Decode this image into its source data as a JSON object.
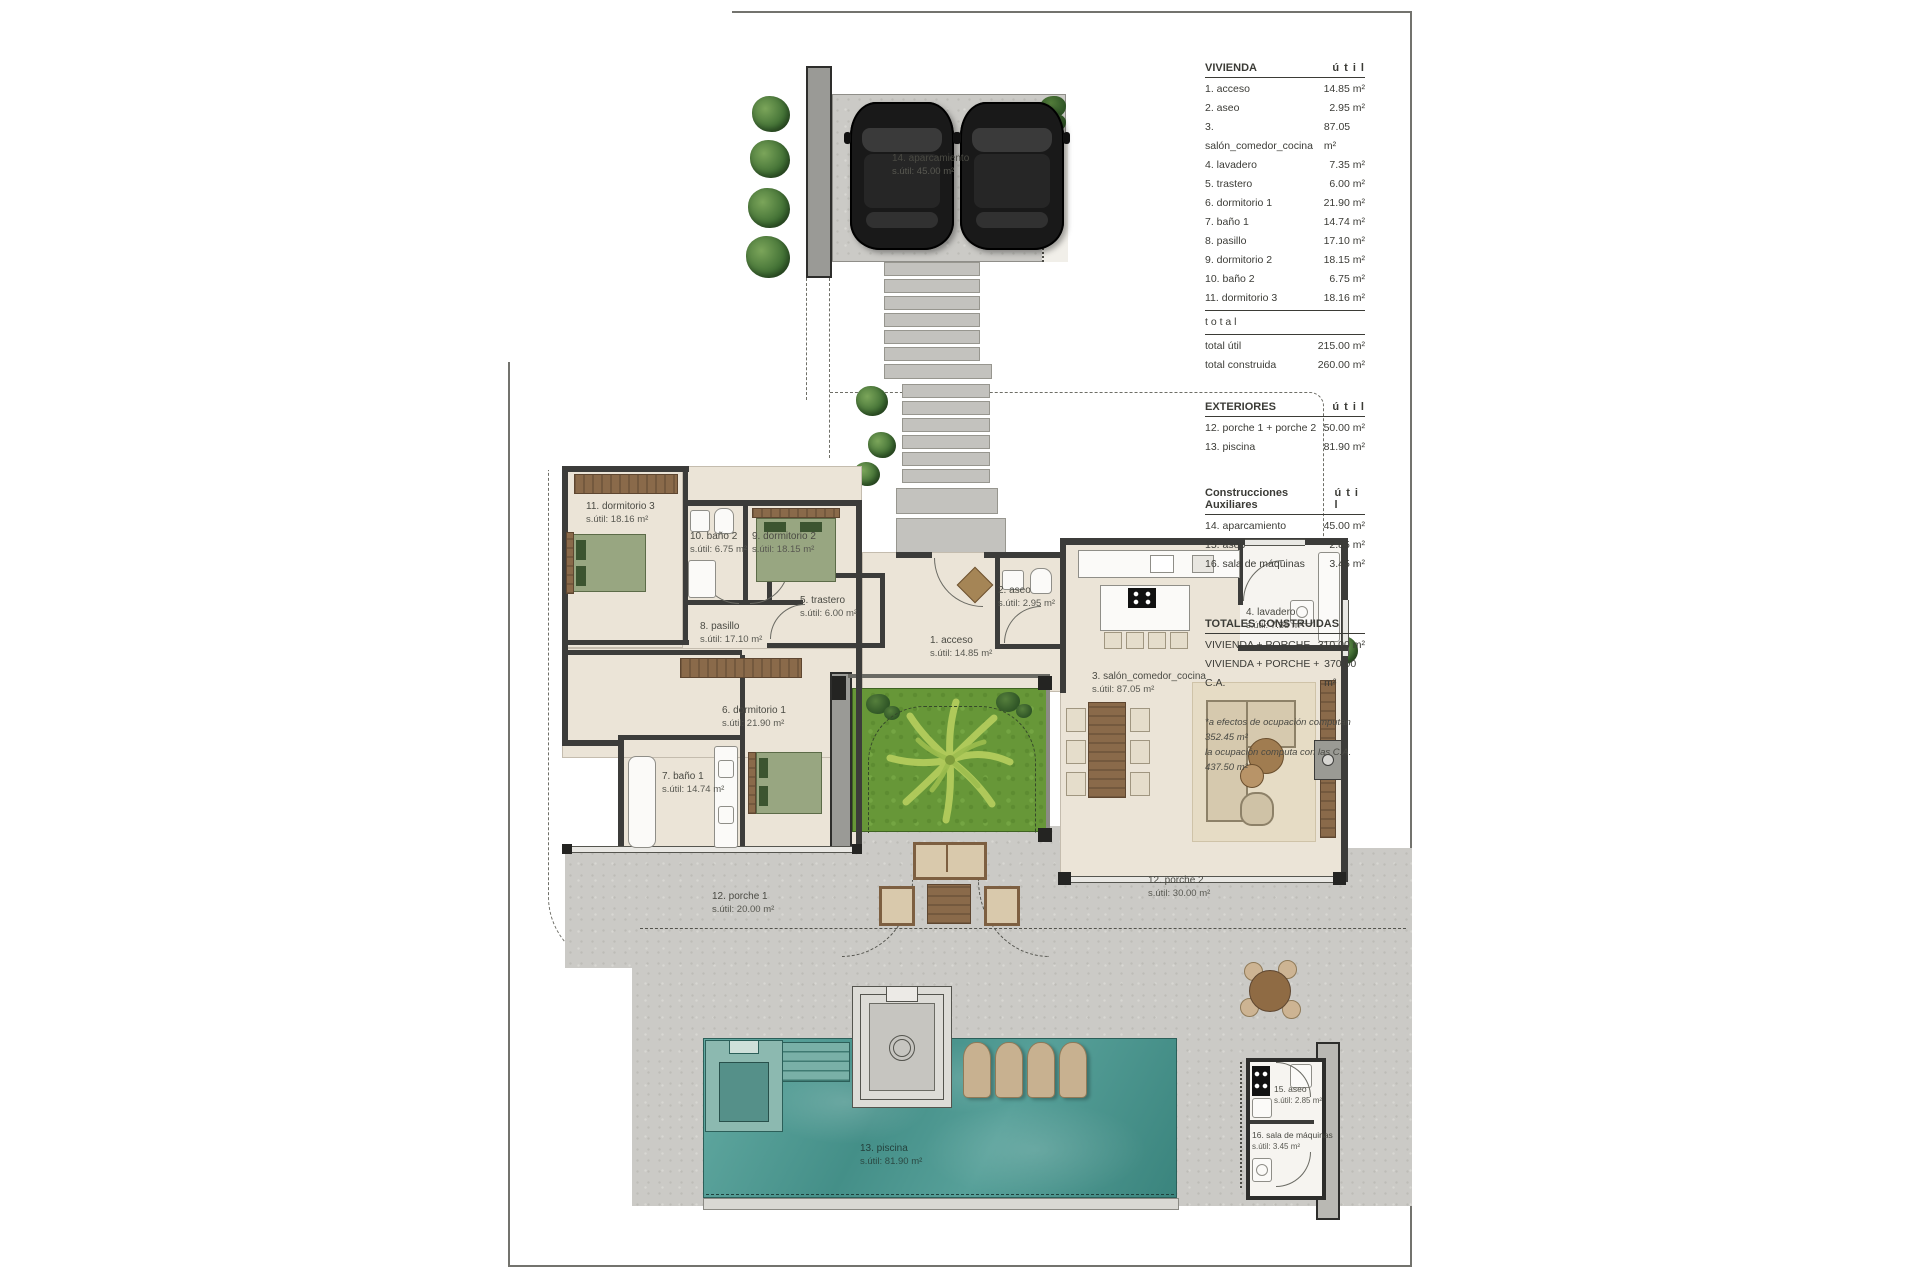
{
  "title": "villa floor plan site drawing",
  "colors": {
    "concrete": "#cbcac6",
    "floor": "#ebe4d7",
    "wall": "#3c3c3a",
    "lawn": "#679738",
    "pool": "#4f9a93",
    "wood": "#8a6a4a",
    "lounger": "#c8b190",
    "text": "#45453f"
  },
  "legend": {
    "vivienda": {
      "title": "VIVIENDA",
      "unit_header": "ú t i l",
      "rows": [
        {
          "label": "1. acceso",
          "area": "14.85 m²"
        },
        {
          "label": "2. aseo",
          "area": "2.95 m²"
        },
        {
          "label": "3. salón_comedor_cocina",
          "area": "87.05 m²"
        },
        {
          "label": "4. lavadero",
          "area": "7.35 m²"
        },
        {
          "label": "5. trastero",
          "area": "6.00 m²"
        },
        {
          "label": "6. dormitorio 1",
          "area": "21.90 m²"
        },
        {
          "label": "7. baño 1",
          "area": "14.74 m²"
        },
        {
          "label": "8. pasillo",
          "area": "17.10 m²"
        },
        {
          "label": "9. dormitorio 2",
          "area": "18.15 m²"
        },
        {
          "label": "10. baño 2",
          "area": "6.75 m²"
        },
        {
          "label": "11. dormitorio 3",
          "area": "18.16 m²"
        }
      ],
      "total_label": "t o t a l",
      "totals": [
        {
          "label": "total útil",
          "area": "215.00 m²"
        },
        {
          "label": "total construida",
          "area": "260.00 m²"
        }
      ]
    },
    "exteriores": {
      "title": "EXTERIORES",
      "unit_header": "ú t i l",
      "rows": [
        {
          "label": "12. porche 1 + porche 2",
          "area": "50.00 m²"
        },
        {
          "label": "13. piscina",
          "area": "81.90 m²"
        }
      ]
    },
    "auxiliares": {
      "title": "Construcciones Auxiliares",
      "unit_header": "ú t i l",
      "rows": [
        {
          "label": "14. aparcamiento",
          "area": "45.00 m²"
        },
        {
          "label": "15. aseo",
          "area": "2.85 m²"
        },
        {
          "label": "16. sala de máquinas",
          "area": "3.45 m²"
        }
      ]
    },
    "totales": {
      "title": "TOTALES CONSTRUIDAS",
      "rows": [
        {
          "label": "VIVIENDA + PORCHE",
          "area": "310.00 m²"
        },
        {
          "label": "VIVIENDA + PORCHE + C.A.",
          "area": "370.00 m²"
        }
      ]
    },
    "footnote": [
      "*a efectos de ocupación computan 352.45 m²",
      "la ocupación computa con las C.A. 437.50 m²"
    ]
  },
  "plan": {
    "labels": [
      {
        "name": "1. acceso",
        "area": "s.útil: 14.85 m²"
      },
      {
        "name": "2. aseo",
        "area": "s.útil: 2.95 m²"
      },
      {
        "name": "3. salón_comedor_cocina",
        "area": "s.útil: 87.05 m²"
      },
      {
        "name": "4. lavadero",
        "area": "s.útil: 7.35 m²"
      },
      {
        "name": "5. trastero",
        "area": "s.útil: 6.00 m²"
      },
      {
        "name": "6. dormitorio 1",
        "area": "s.útil: 21.90 m²"
      },
      {
        "name": "7. baño 1",
        "area": "s.útil: 14.74 m²"
      },
      {
        "name": "8. pasillo",
        "area": "s.útil: 17.10 m²"
      },
      {
        "name": "9. dormitorio 2",
        "area": "s.útil: 18.15 m²"
      },
      {
        "name": "10. baño 2",
        "area": "s.útil: 6.75 m²"
      },
      {
        "name": "11. dormitorio 3",
        "area": "s.útil: 18.16 m²"
      },
      {
        "name": "12. porche 1",
        "area": "s.útil: 20.00 m²"
      },
      {
        "name": "12. porche 2",
        "area": "s.útil: 30.00 m²"
      },
      {
        "name": "13. piscina",
        "area": "s.útil: 81.90 m²"
      },
      {
        "name": "14. aparcamiento",
        "area": "s.útil: 45.00 m²"
      },
      {
        "name": "15. aseo",
        "area": "s.útil: 2.85 m²"
      },
      {
        "name": "16. sala de máquinas",
        "area": "s.útil: 3.45 m²"
      }
    ]
  }
}
